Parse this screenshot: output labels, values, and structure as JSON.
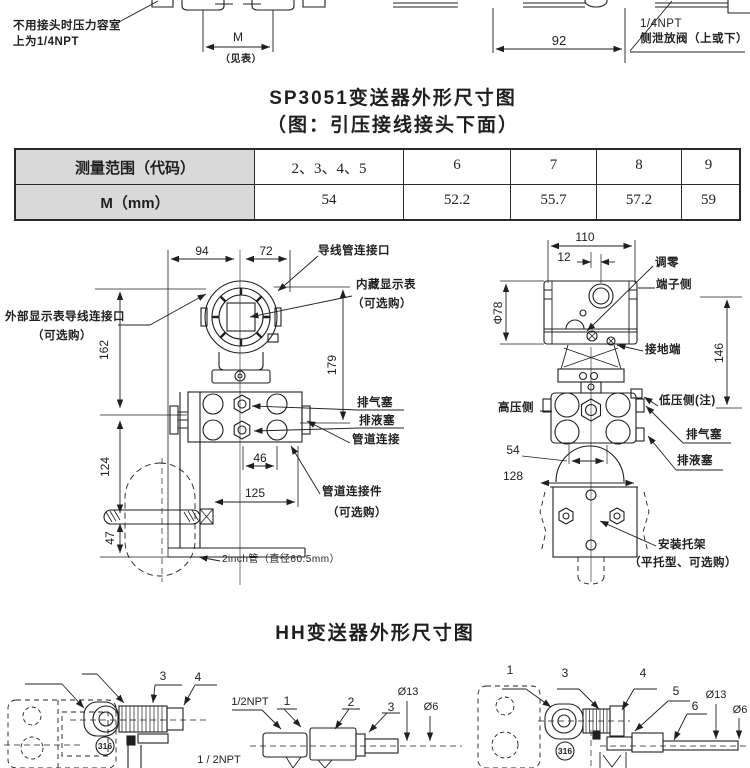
{
  "colors": {
    "ink": "#1f1f1f",
    "table_head_bg": "#d9d9d9"
  },
  "top": {
    "note1": "不用接头时压力容室",
    "note2": "上为1/4NPT",
    "m_label": "M",
    "m_note": "（见表）",
    "dim92": "92",
    "valve1": "1/4NPT",
    "valve2": "侧泄放阀（上或下）"
  },
  "title": {
    "main": "SP3051变送器外形尺寸图",
    "sub": "（图：引压接线接头下面）"
  },
  "table": {
    "rows": [
      {
        "head": "测量范围（代码）",
        "cells": [
          "2、3、4、5",
          "6",
          "7",
          "8",
          "9"
        ]
      },
      {
        "head": "M（mm）",
        "cells": [
          "54",
          "52.2",
          "55.7",
          "57.2",
          "59"
        ]
      }
    ]
  },
  "front": {
    "d94": "94",
    "d72": "72",
    "d162": "162",
    "d179": "179",
    "d124": "124",
    "d47": "47",
    "d46": "46",
    "d125": "125",
    "ext_display": "外部显示表导线连接口",
    "ext_display_opt": "（可选购）",
    "conduit": "导线管连接口",
    "built_in": "内藏显示表",
    "built_in_opt": "（可选购）",
    "vent": "排气塞",
    "drain": "排液塞",
    "pipe_conn": "管道连接",
    "pipe_fitting": "管道连接件",
    "pipe_fitting_opt": "（可选购）",
    "pipe2": "2inch管（直径60.5mm）"
  },
  "side": {
    "d110": "110",
    "d12": "12",
    "d78": "Φ78",
    "d146": "146",
    "d54": "54",
    "d128": "128",
    "zero": "调零",
    "terminal": "端子侧",
    "ground": "接地端",
    "high": "高压侧",
    "low": "低压侧(注)",
    "vent": "排气塞",
    "drain": "排液塞",
    "bracket": "安装托架",
    "bracket_opt": "（平托型、可选购）"
  },
  "hh": {
    "title": "HH变送器外形尺寸图",
    "left": {
      "n3": "3",
      "n4": "4",
      "npt_b": "1 / 2NPT",
      "mat": "316"
    },
    "mid": {
      "npt": "1/2NPT",
      "n1": "1",
      "n2": "2",
      "n3": "3",
      "d13": "Ø13",
      "d6": "Ø6"
    },
    "right": {
      "n1": "1",
      "n3": "3",
      "n4": "4",
      "n5": "5",
      "n6": "6",
      "d13": "Ø13",
      "d6": "Ø6",
      "mat": "316"
    }
  }
}
